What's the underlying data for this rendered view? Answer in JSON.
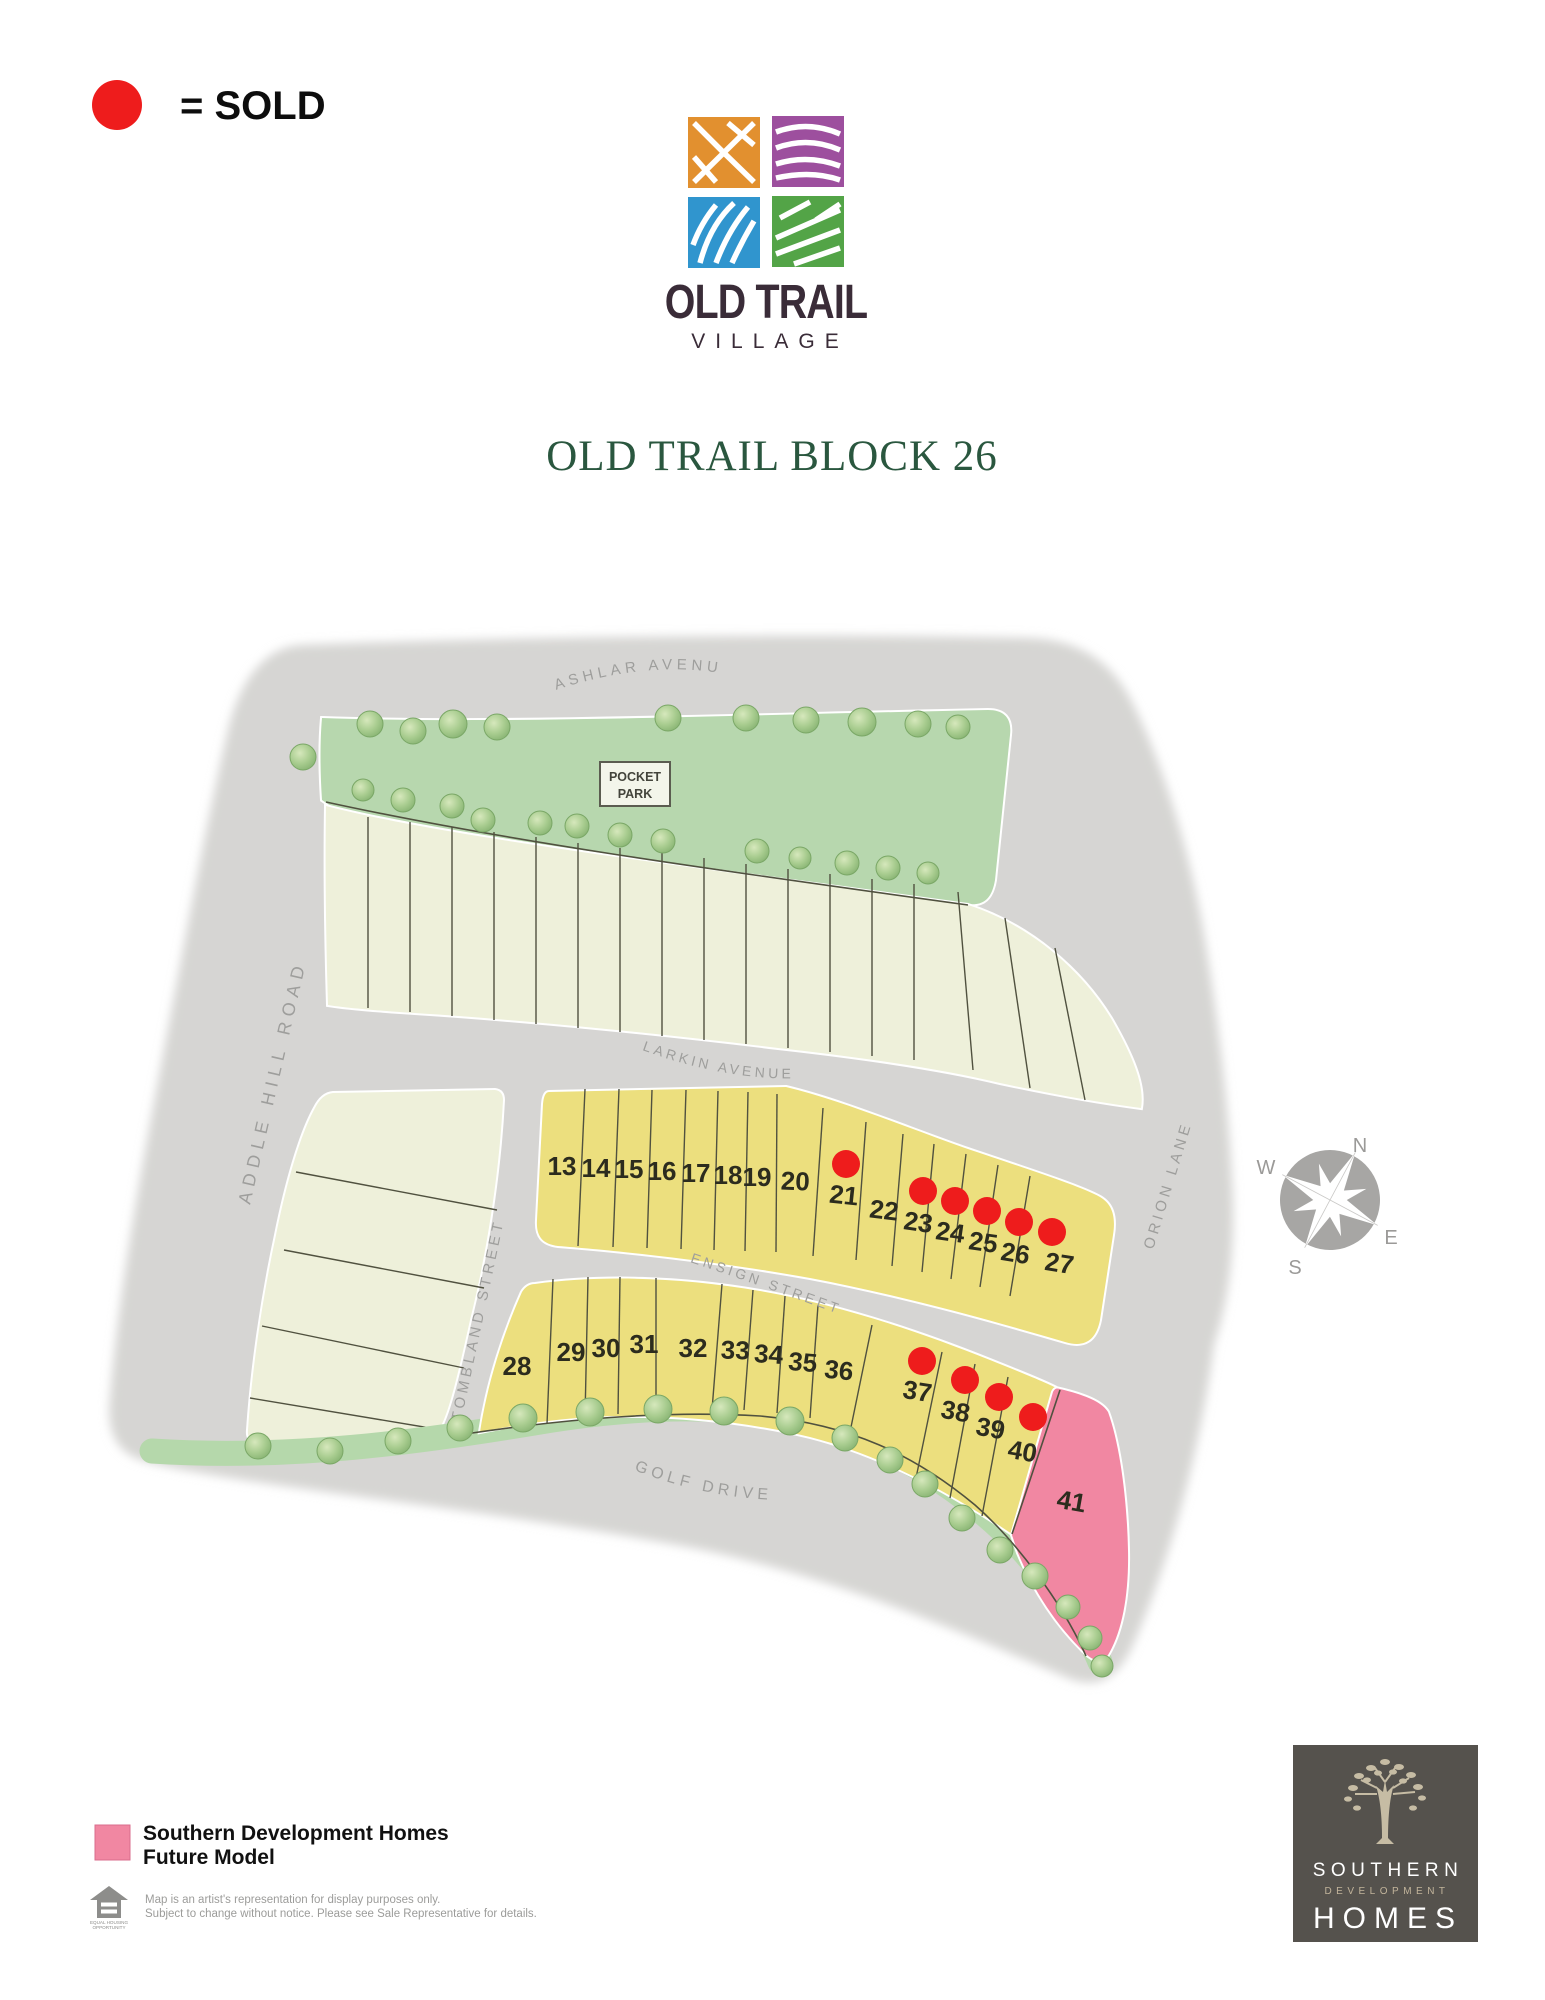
{
  "legend_sold": {
    "label": "= SOLD",
    "dot_color": "#ee1c1c"
  },
  "logo": {
    "line1": "OLD TRAIL",
    "line2": "VILLAGE",
    "square_colors": {
      "top_left": "#e2902f",
      "top_right": "#9d4f9e",
      "bottom_left": "#3095ce",
      "bottom_right": "#53a447"
    }
  },
  "title": "OLD TRAIL BLOCK 26",
  "map": {
    "streets": {
      "ashlar": "ASHLAR AVENUE",
      "larkin": "LARKIN AVENUE",
      "ensign": "ENSIGN STREET",
      "golf": "GOLF DRIVE",
      "addle": "ADDLE HILL ROAD",
      "tombland": "TOMBLAND STREET",
      "orion": "ORION LANE"
    },
    "pocket_park": {
      "line1": "POCKET",
      "line2": "PARK"
    },
    "compass": {
      "n": "N",
      "e": "E",
      "s": "S",
      "w": "W"
    },
    "sold_lots": [
      21,
      23,
      24,
      25,
      26,
      27,
      37,
      38,
      39,
      40
    ],
    "future_model_lot": 41,
    "lots": [
      {
        "number": "13",
        "sold": false
      },
      {
        "number": "14",
        "sold": false
      },
      {
        "number": "15",
        "sold": false
      },
      {
        "number": "16",
        "sold": false
      },
      {
        "number": "17",
        "sold": false
      },
      {
        "number": "18",
        "sold": false
      },
      {
        "number": "19",
        "sold": false
      },
      {
        "number": "20",
        "sold": false
      },
      {
        "number": "21",
        "sold": true
      },
      {
        "number": "22",
        "sold": false
      },
      {
        "number": "23",
        "sold": true
      },
      {
        "number": "24",
        "sold": true
      },
      {
        "number": "25",
        "sold": true
      },
      {
        "number": "26",
        "sold": true
      },
      {
        "number": "27",
        "sold": true
      },
      {
        "number": "28",
        "sold": false
      },
      {
        "number": "29",
        "sold": false
      },
      {
        "number": "30",
        "sold": false
      },
      {
        "number": "31",
        "sold": false
      },
      {
        "number": "32",
        "sold": false
      },
      {
        "number": "33",
        "sold": false
      },
      {
        "number": "34",
        "sold": false
      },
      {
        "number": "35",
        "sold": false
      },
      {
        "number": "36",
        "sold": false
      },
      {
        "number": "37",
        "sold": true
      },
      {
        "number": "38",
        "sold": true
      },
      {
        "number": "39",
        "sold": true
      },
      {
        "number": "40",
        "sold": true
      },
      {
        "number": "41",
        "sold": false
      }
    ],
    "colors": {
      "road": "#d6d5d3",
      "park": "#b7d7ae",
      "open_lot": "#eef0da",
      "available_lot": "#ecdf7e",
      "future_model": "#f187a2",
      "sold_dot": "#ee1c1c",
      "lot41_label": "#a0519c"
    }
  },
  "legend_future": {
    "swatch_color": "#f187a2",
    "line1": "Southern Development Homes",
    "line2": "Future Model"
  },
  "disclaimer": {
    "line1": "Map is an artist's representation for display purposes only.",
    "line2": "Subject to change without notice. Please see Sale Representative for details.",
    "equal_housing_line1": "EQUAL HOUSING",
    "equal_housing_line2": "OPPORTUNITY"
  },
  "builder_logo": {
    "line1": "SOUTHERN",
    "line2": "DEVELOPMENT",
    "line3": "HOMES"
  }
}
